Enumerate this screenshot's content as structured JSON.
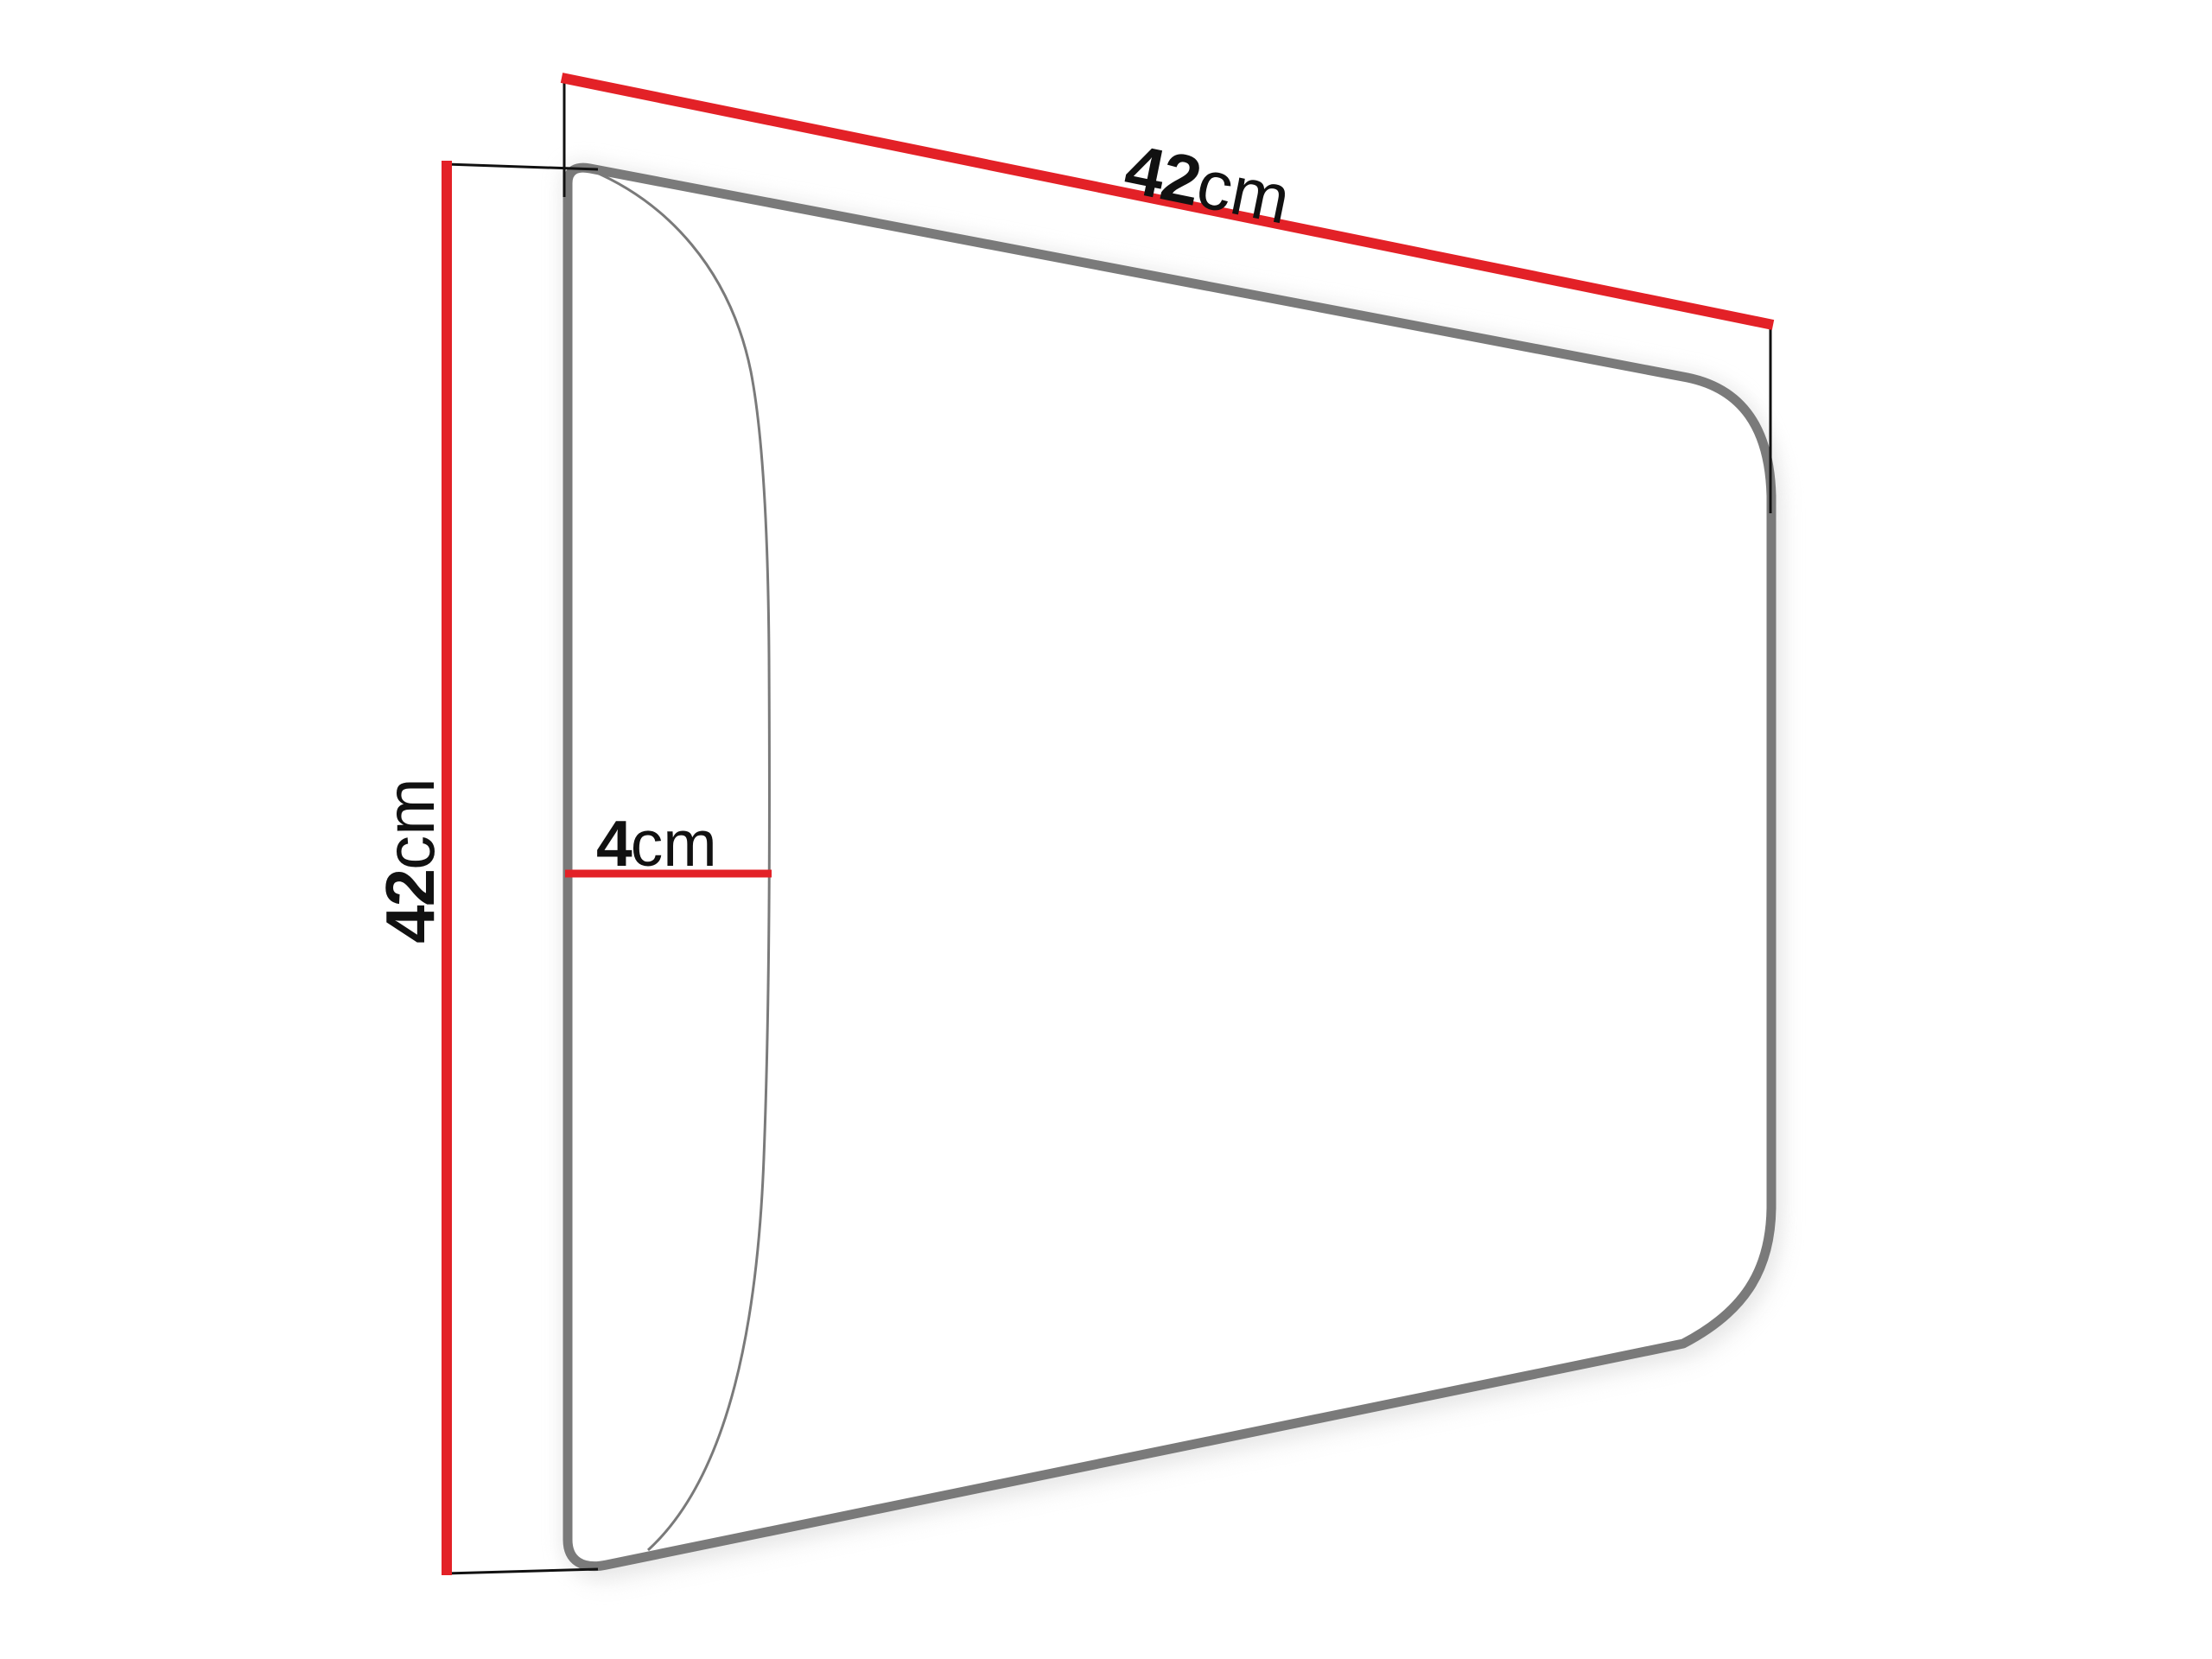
{
  "dimensions": {
    "width": {
      "value": "42",
      "unit": "cm"
    },
    "height": {
      "value": "42",
      "unit": "cm"
    },
    "depth": {
      "value": "4",
      "unit": "cm"
    }
  },
  "colors": {
    "dimension_line_red": "#e32127",
    "panel_outline_gray": "#7a7a7a",
    "extension_line_black": "#111111",
    "label_text": "#111111",
    "background": "#ffffff"
  }
}
